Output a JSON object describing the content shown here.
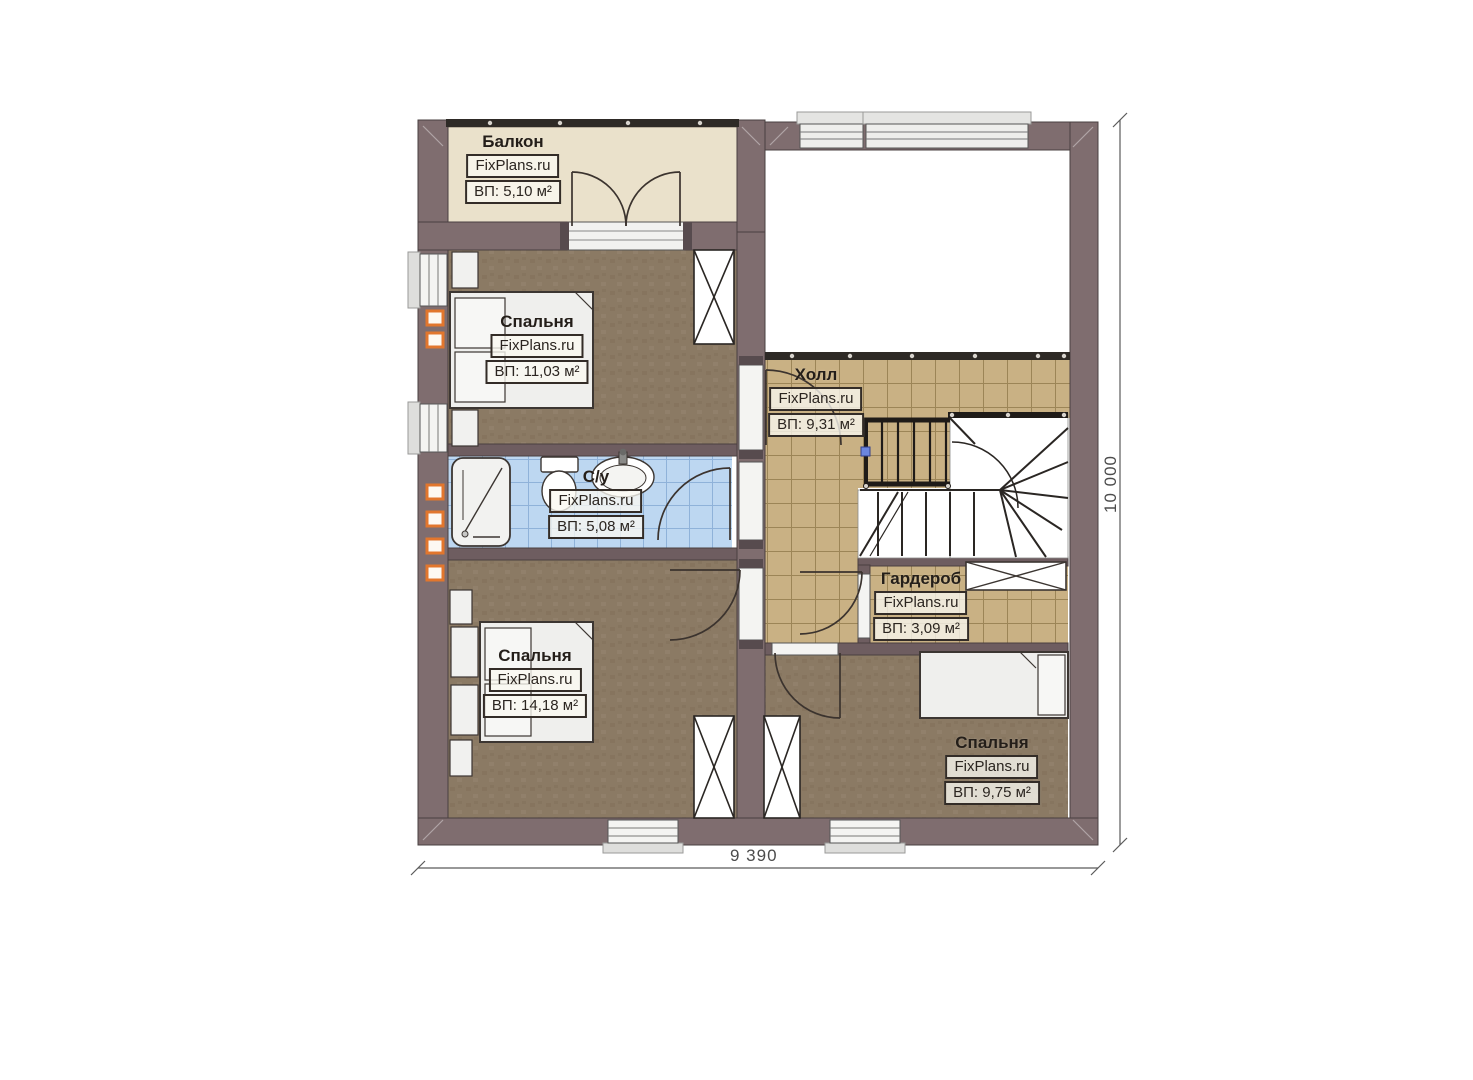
{
  "plan": {
    "watermark": "FixPlans.ru",
    "dimensions": {
      "width_label": "9 390",
      "height_label": "10 000"
    },
    "rooms": [
      {
        "name": "Балкон",
        "brand": "FixPlans.ru",
        "area": "ВП: 5,10 м²"
      },
      {
        "name": "Спальня",
        "brand": "FixPlans.ru",
        "area": "ВП: 11,03 м²"
      },
      {
        "name": "Холл",
        "brand": "FixPlans.ru",
        "area": "ВП: 9,31 м²"
      },
      {
        "name": "С/у",
        "brand": "FixPlans.ru",
        "area": "ВП: 5,08 м²"
      },
      {
        "name": "Гардероб",
        "brand": "FixPlans.ru",
        "area": "ВП: 3,09 м²"
      },
      {
        "name": "Спальня",
        "brand": "FixPlans.ru",
        "area": "ВП: 14,18 м²"
      },
      {
        "name": "Спальня",
        "brand": "FixPlans.ru",
        "area": "ВП: 9,75 м²"
      }
    ],
    "colors": {
      "wall": "#7f6d6f",
      "partition": "#6e5d60",
      "bedroom_floor": "#8b7a64",
      "tile_floor": "#c9b184",
      "bath_tile": "#bdd7f1",
      "balcony_floor": "#eae1cb",
      "accent_marker": "#e2762d"
    }
  }
}
